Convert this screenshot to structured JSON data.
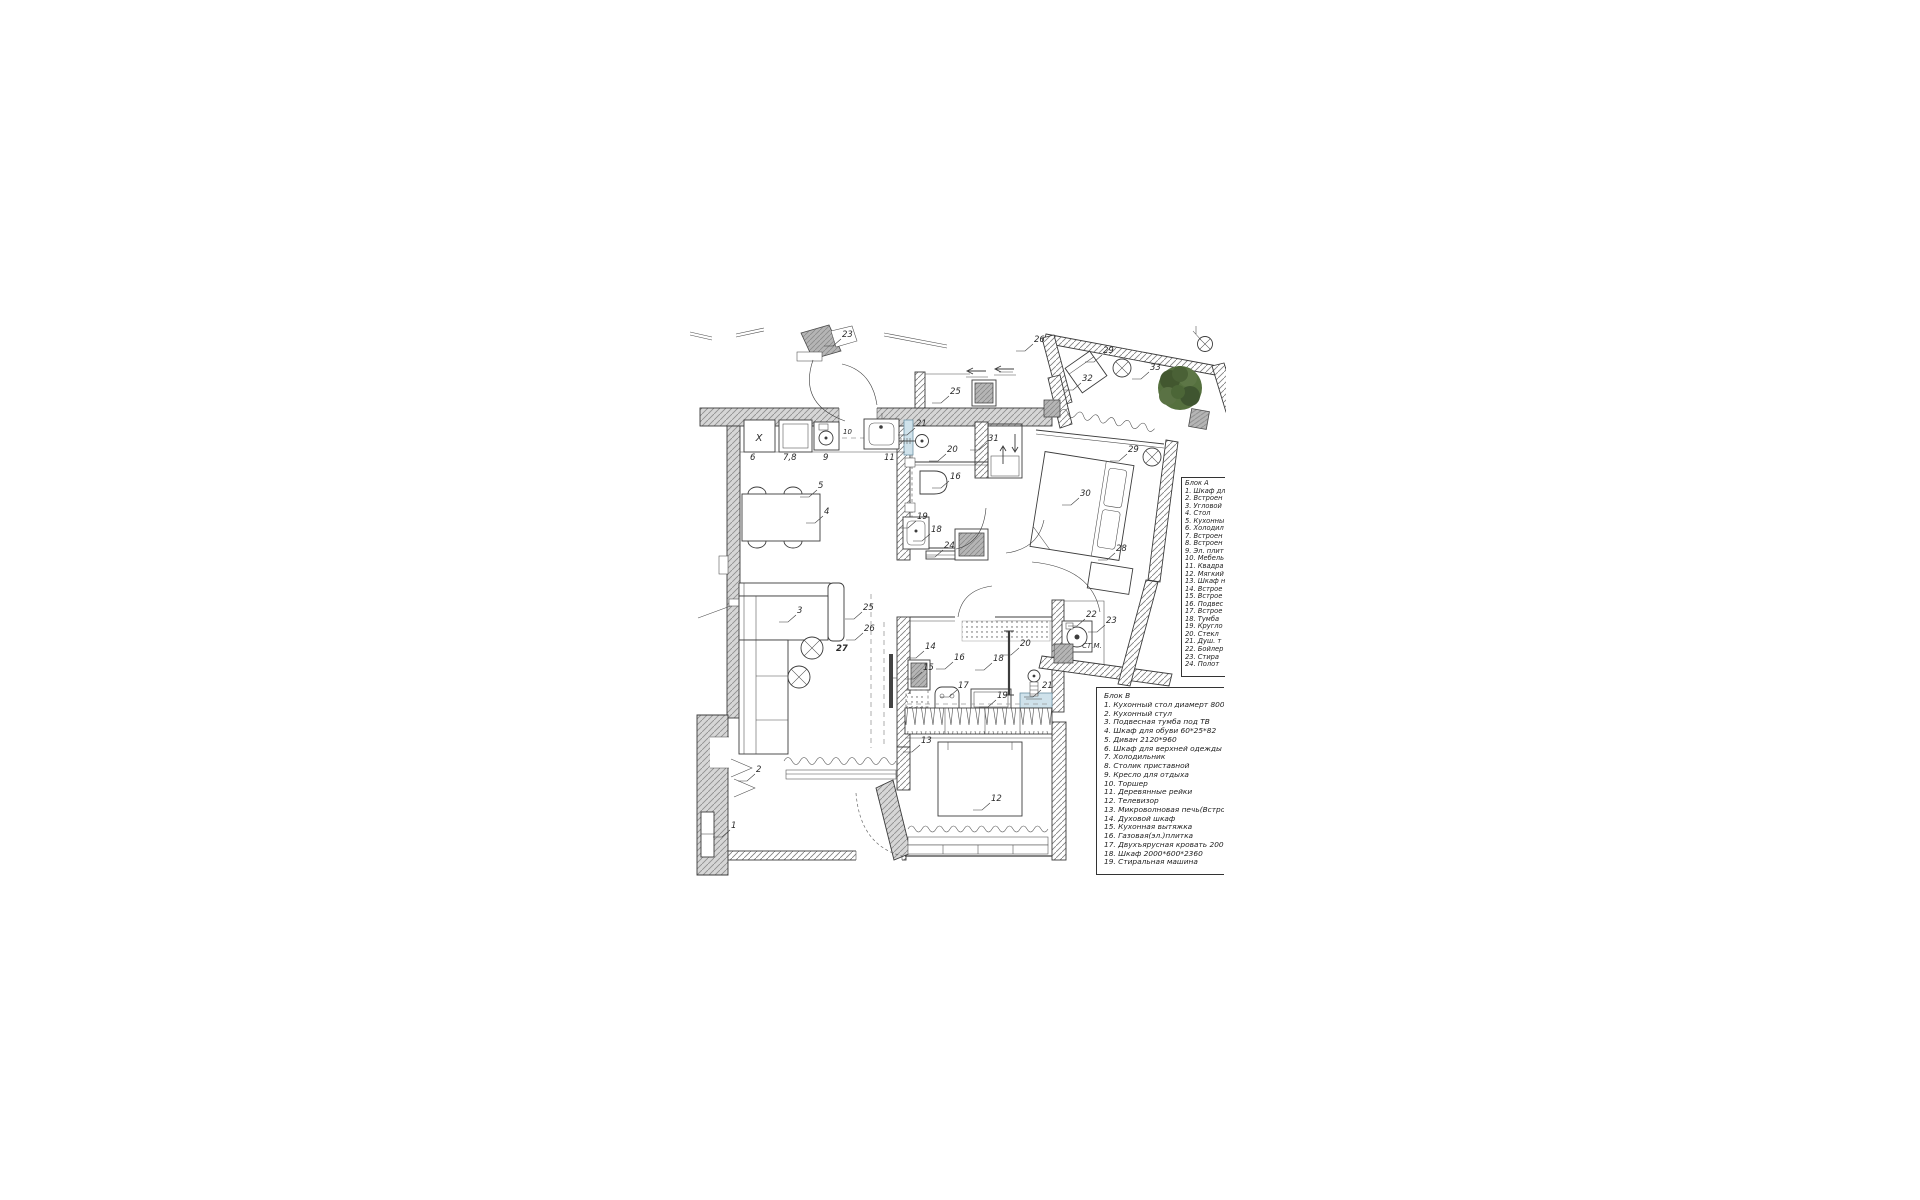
{
  "page": {
    "background": "#ffffff",
    "description_title": "Apartment furniture floor plan"
  },
  "colors": {
    "line": "#3c3c3c",
    "wall_hatch": "#8f8f8f",
    "wall_fill_gray": "#d6d6d6",
    "gray_box": "#b5b5b5",
    "blue": "#cfe2eb",
    "tree_green": "#55703e",
    "tv_black": "#444444"
  },
  "texts": {
    "fridge_mark": "X",
    "washing_machine": "СТ.М."
  },
  "legend_a": {
    "title": "Блок А",
    "items": [
      "1. Шкаф дл",
      "2. Встроен",
      "3. Угловой",
      "4. Стол",
      "5. Кухонны",
      "6. Холодил",
      "7. Встроен",
      "8. Встроен",
      "9. Эл. плит",
      "10. Мебель",
      "11. Квадра",
      "12. Мягкий",
      "13. Шкаф н",
      "14. Встрое",
      "15. Встрое",
      "16. Подвес",
      "17. Встрое",
      "18. Тумба",
      "19. Кругло",
      "20. Стекл",
      "21. Душ. т",
      "22. Бойлер",
      "23. Стира",
      "24. Полот"
    ]
  },
  "legend_b": {
    "title": "Блок В",
    "items": [
      "1. Кухонный стол диамерт 800",
      "2. Кухонный стул",
      "3. Подвесная тумба под ТВ",
      "4. Шкаф для обуви 60*25*82",
      "5. Диван 2120*960",
      "6. Шкаф для верхней одежды",
      "7. Холодильник",
      "8. Столик приставной",
      "9. Кресло для отдыха",
      "10. Торшер",
      "11. Деревянные рейки",
      "12. Телевизор",
      "13. Микроволновая печь(Встро",
      "14. Духовой шкаф",
      "15. Кухонная вытяжка",
      "16. Газовая(эл.)плитка",
      "17. Двухъярусная кровать 200",
      "18. Шкаф 2000*600*2360",
      "19. Стиральная машина"
    ]
  },
  "labels": [
    {
      "t": "23",
      "x": 842,
      "y": 337
    },
    {
      "t": "26",
      "x": 1034,
      "y": 342
    },
    {
      "t": "25",
      "x": 950,
      "y": 394
    },
    {
      "t": "29",
      "x": 1103,
      "y": 353
    },
    {
      "t": "32",
      "x": 1082,
      "y": 381
    },
    {
      "t": "33",
      "x": 1150,
      "y": 370
    },
    {
      "t": "29",
      "x": 1128,
      "y": 452
    },
    {
      "t": "31",
      "x": 988,
      "y": 441
    },
    {
      "t": "6",
      "x": 750,
      "y": 460,
      "nl": 1
    },
    {
      "t": "7,8",
      "x": 783,
      "y": 460,
      "nl": 1
    },
    {
      "t": "9",
      "x": 823,
      "y": 460,
      "nl": 1
    },
    {
      "t": "10",
      "x": 843,
      "y": 434,
      "nl": 1,
      "fs": 7
    },
    {
      "t": "11",
      "x": 884,
      "y": 460,
      "nl": 1
    },
    {
      "t": "21",
      "x": 916,
      "y": 426
    },
    {
      "t": "20",
      "x": 947,
      "y": 452
    },
    {
      "t": "16",
      "x": 950,
      "y": 479
    },
    {
      "t": "30",
      "x": 1080,
      "y": 496
    },
    {
      "t": "5",
      "x": 818,
      "y": 488
    },
    {
      "t": "4",
      "x": 824,
      "y": 514
    },
    {
      "t": "19",
      "x": 917,
      "y": 519
    },
    {
      "t": "18",
      "x": 931,
      "y": 532
    },
    {
      "t": "24",
      "x": 944,
      "y": 548
    },
    {
      "t": "28",
      "x": 1116,
      "y": 551
    },
    {
      "t": "3",
      "x": 797,
      "y": 613
    },
    {
      "t": "25",
      "x": 863,
      "y": 610
    },
    {
      "t": "26",
      "x": 864,
      "y": 631
    },
    {
      "t": "27",
      "x": 836,
      "y": 651,
      "b": 1,
      "nl": 1
    },
    {
      "t": "22",
      "x": 1086,
      "y": 617
    },
    {
      "t": "23",
      "x": 1106,
      "y": 623
    },
    {
      "t": "14",
      "x": 925,
      "y": 649
    },
    {
      "t": "15",
      "x": 923,
      "y": 670
    },
    {
      "t": "16",
      "x": 954,
      "y": 660
    },
    {
      "t": "18",
      "x": 993,
      "y": 661
    },
    {
      "t": "17",
      "x": 958,
      "y": 688
    },
    {
      "t": "19",
      "x": 997,
      "y": 698
    },
    {
      "t": "20",
      "x": 1020,
      "y": 646
    },
    {
      "t": "21",
      "x": 1042,
      "y": 688
    },
    {
      "t": "2",
      "x": 756,
      "y": 772
    },
    {
      "t": "1",
      "x": 731,
      "y": 828
    },
    {
      "t": "13",
      "x": 921,
      "y": 743
    },
    {
      "t": "12",
      "x": 991,
      "y": 801
    }
  ]
}
